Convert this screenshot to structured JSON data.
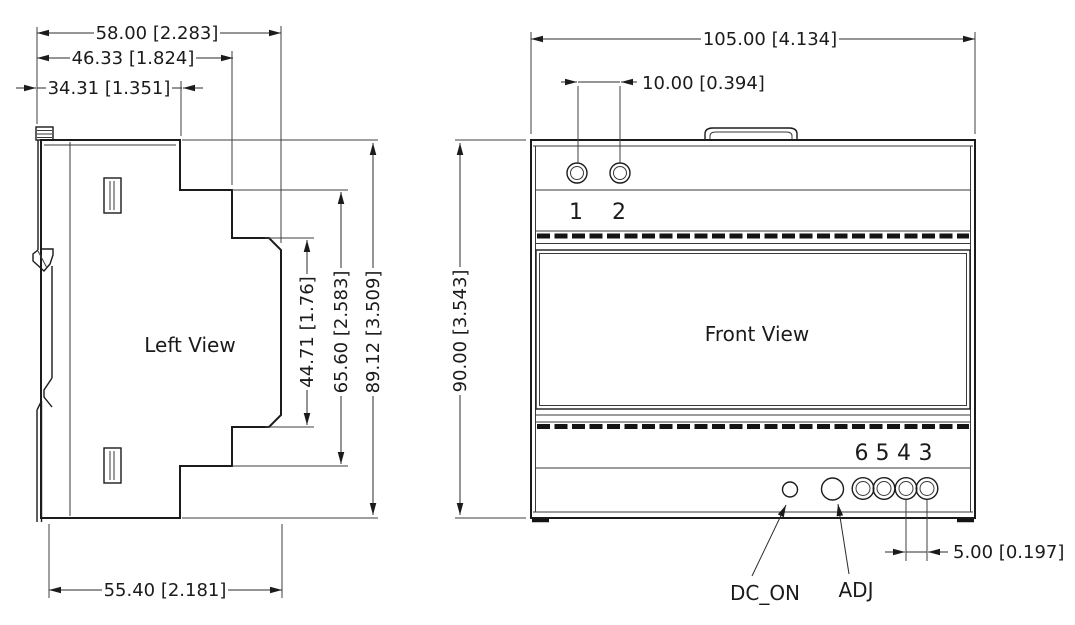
{
  "left_view": {
    "label": "Left View",
    "dim_width_overall": "58.00 [2.283]",
    "dim_width_mid": "46.33 [1.824]",
    "dim_width_inner": "34.31 [1.351]",
    "dim_width_bottom": "55.40 [2.181]",
    "dim_height_inner": "44.71 [1.76]",
    "dim_height_mid": "65.60 [2.583]",
    "dim_height_overall": "89.12 [3.509]"
  },
  "front_view": {
    "label": "Front View",
    "dim_width_overall": "105.00 [4.134]",
    "dim_top_hole_spacing": "10.00 [0.394]",
    "dim_height_overall": "90.00 [3.543]",
    "dim_terminal_spacing": "5.00 [0.197]",
    "top_terminals": [
      "1",
      "2"
    ],
    "bottom_terminals": [
      "6",
      "5",
      "4",
      "3"
    ],
    "led_label": "DC_ON",
    "adj_label": "ADJ"
  }
}
